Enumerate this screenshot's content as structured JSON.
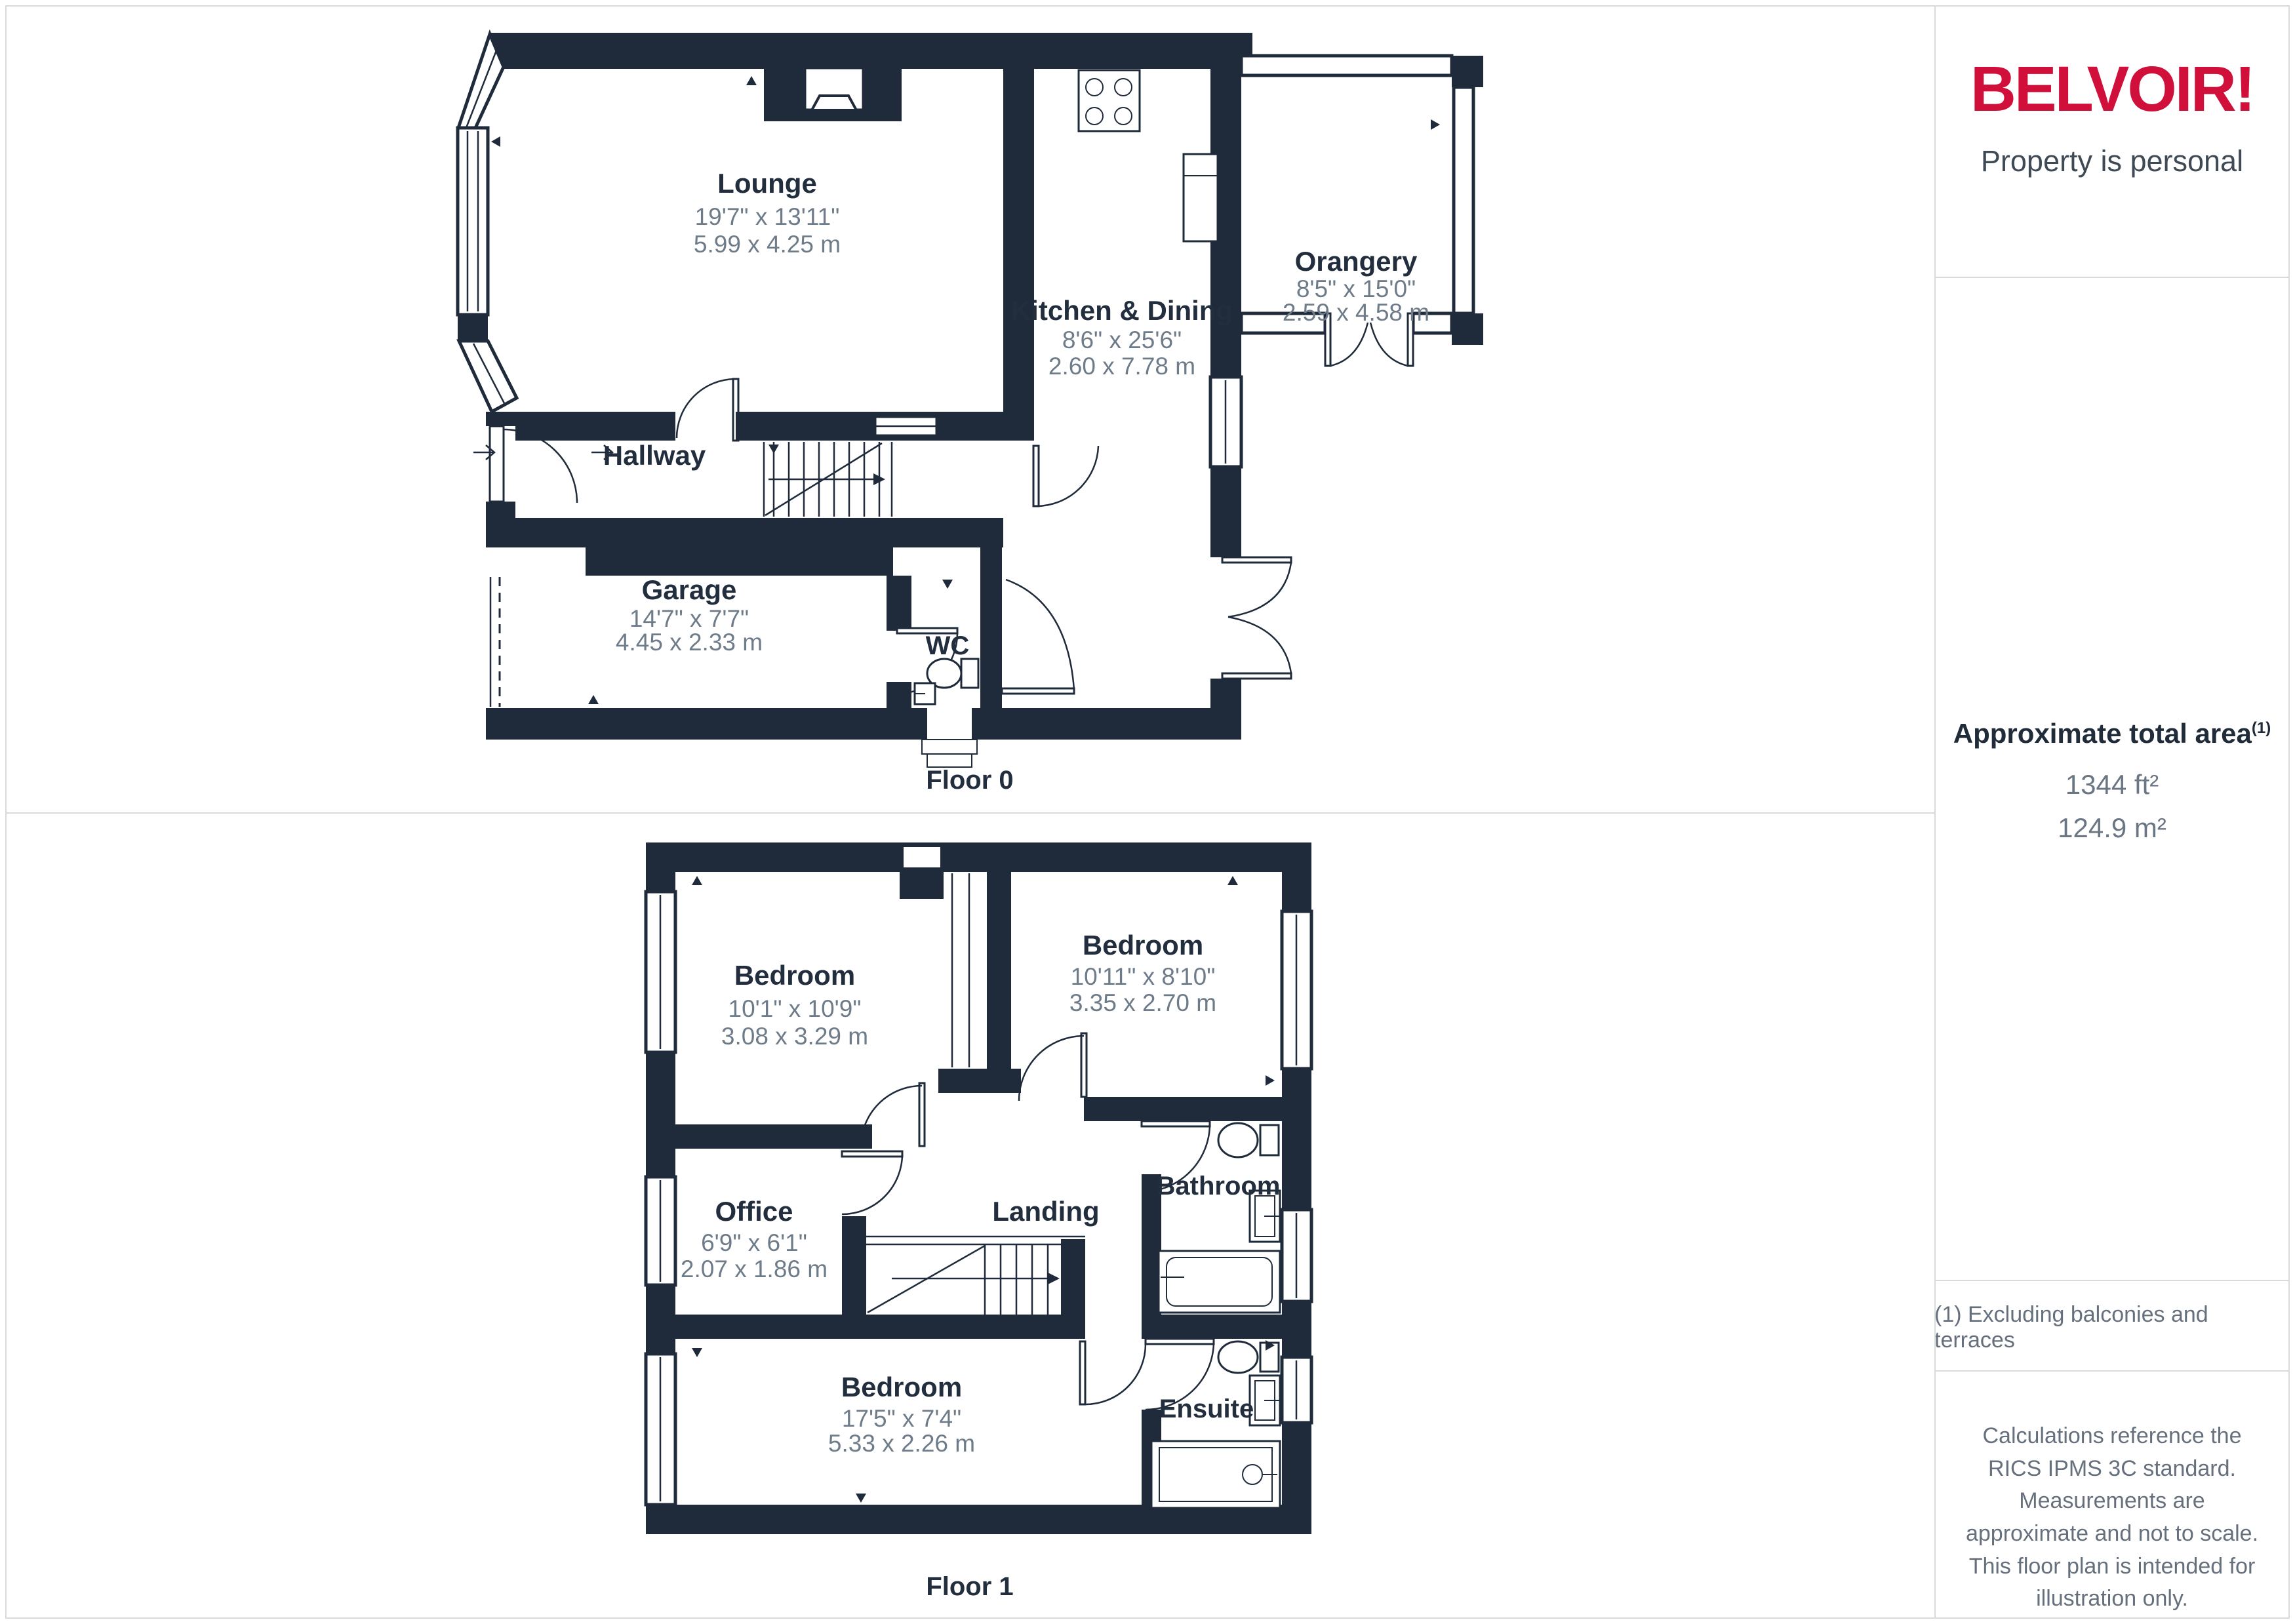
{
  "floor0": {
    "name": "Floor 0",
    "rooms": {
      "lounge": {
        "name": "Lounge",
        "size_imperial": "19'7\" x 13'11\"",
        "size_metric": "5.99 x 4.25 m"
      },
      "kitchen": {
        "name": "Kitchen & Dining",
        "size_imperial": "8'6\" x 25'6\"",
        "size_metric": "2.60 x 7.78 m"
      },
      "orangery": {
        "name": "Orangery",
        "size_imperial": "8'5\" x 15'0\"",
        "size_metric": "2.59 x 4.58 m"
      },
      "hallway": {
        "name": "Hallway"
      },
      "garage": {
        "name": "Garage",
        "size_imperial": "14'7\" x 7'7\"",
        "size_metric": "4.45 x 2.33 m"
      },
      "wc": {
        "name": "WC"
      }
    }
  },
  "floor1": {
    "name": "Floor 1",
    "rooms": {
      "bedroom_front": {
        "name": "Bedroom",
        "size_imperial": "10'1\" x 10'9\"",
        "size_metric": "3.08 x 3.29 m"
      },
      "bedroom_back": {
        "name": "Bedroom",
        "size_imperial": "10'11\" x 8'10\"",
        "size_metric": "3.35 x 2.70 m"
      },
      "bedroom_main": {
        "name": "Bedroom",
        "size_imperial": "17'5\" x 7'4\"",
        "size_metric": "5.33 x 2.26 m"
      },
      "office": {
        "name": "Office",
        "size_imperial": "6'9\" x 6'1\"",
        "size_metric": "2.07 x 1.86 m"
      },
      "landing": {
        "name": "Landing"
      },
      "bathroom": {
        "name": "Bathroom"
      },
      "ensuite": {
        "name": "Ensuite"
      }
    }
  },
  "sidebar": {
    "brand": "BELVOIR!",
    "tagline": "Property is personal",
    "area_title": "Approximate total area",
    "area_superscript": "(1)",
    "area_ft": "1344 ft²",
    "area_m": "124.9 m²",
    "footnote": "(1) Excluding balconies and terraces",
    "disclaimer": "Calculations reference the RICS IPMS 3C standard. Measurements are approximate and not to scale. This floor plan is intended for illustration only.",
    "provider": "GIRAFFE",
    "provider_suffix": "360",
    "brand_color": "#d0103a",
    "wall_color": "#1f2b3a"
  }
}
